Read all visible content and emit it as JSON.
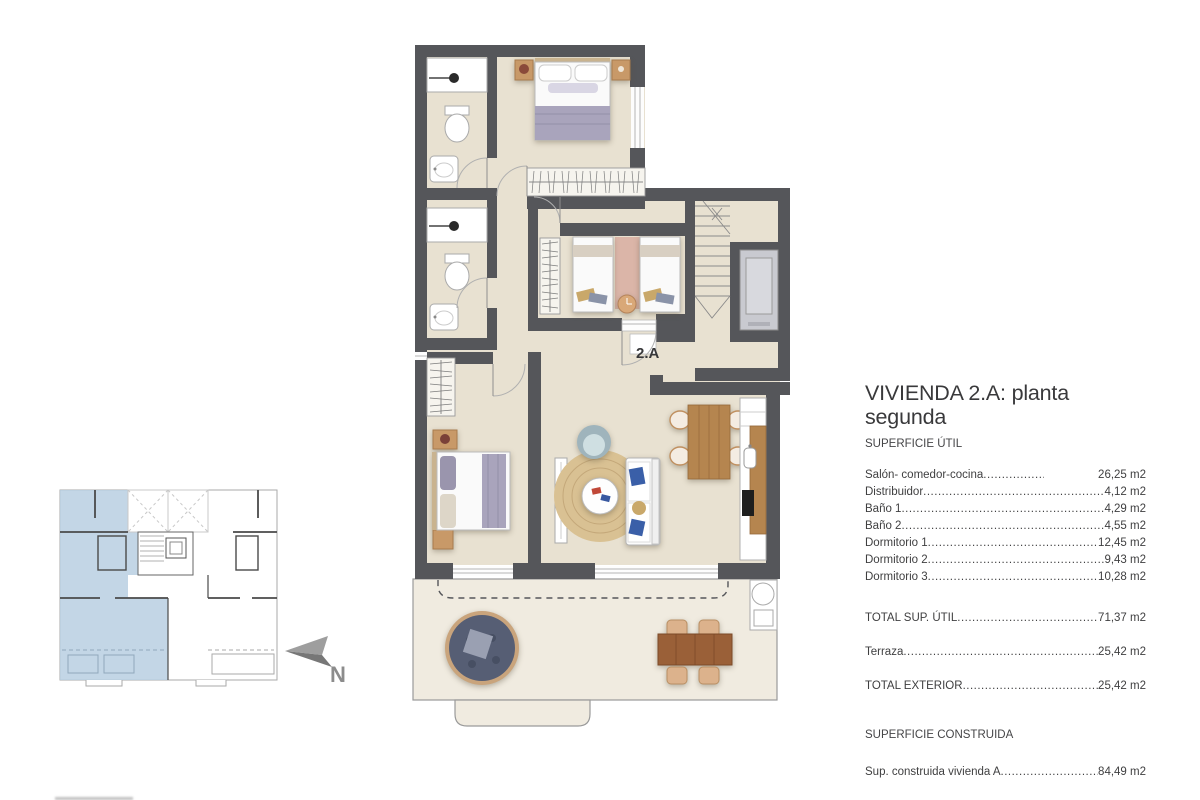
{
  "colors": {
    "wall": "#55565a",
    "floor_interior": "#e8e1d1",
    "floor_terrace": "#f0ebe0",
    "keyplan_highlight": "#b9cfe2",
    "wood": "#b5854f",
    "text": "#3b3b3b"
  },
  "floor_plan": {
    "unit_label": "2.A"
  },
  "key_plan": {
    "north_label": "N"
  },
  "info_panel": {
    "title": "VIVIENDA 2.A: planta segunda",
    "useful_surface_heading": "SUPERFICIE ÚTIL",
    "rows": [
      {
        "label": "Salón- comedor-cocina",
        "value": "26,25 m2"
      },
      {
        "label": "Distribuidor",
        "value": "4,12 m2"
      },
      {
        "label": "Baño 1",
        "value": "4,29 m2"
      },
      {
        "label": "Baño 2",
        "value": "4,55 m2"
      },
      {
        "label": "Dormitorio 1",
        "value": "12,45 m2"
      },
      {
        "label": "Dormitorio 2",
        "value": "9,43 m2"
      },
      {
        "label": "Dormitorio 3",
        "value": "10,28 m2"
      }
    ],
    "total_useful": {
      "label": "TOTAL SUP. ÚTIL",
      "value": "71,37 m2"
    },
    "terrace": {
      "label": "Terraza",
      "value": "25,42 m2"
    },
    "total_exterior": {
      "label": "TOTAL EXTERIOR",
      "value": "25,42 m2"
    },
    "built_surface_heading": "SUPERFICIE CONSTRUIDA",
    "built_row": {
      "label": "Sup. construida vivienda A",
      "value": "84,49 m2"
    }
  }
}
